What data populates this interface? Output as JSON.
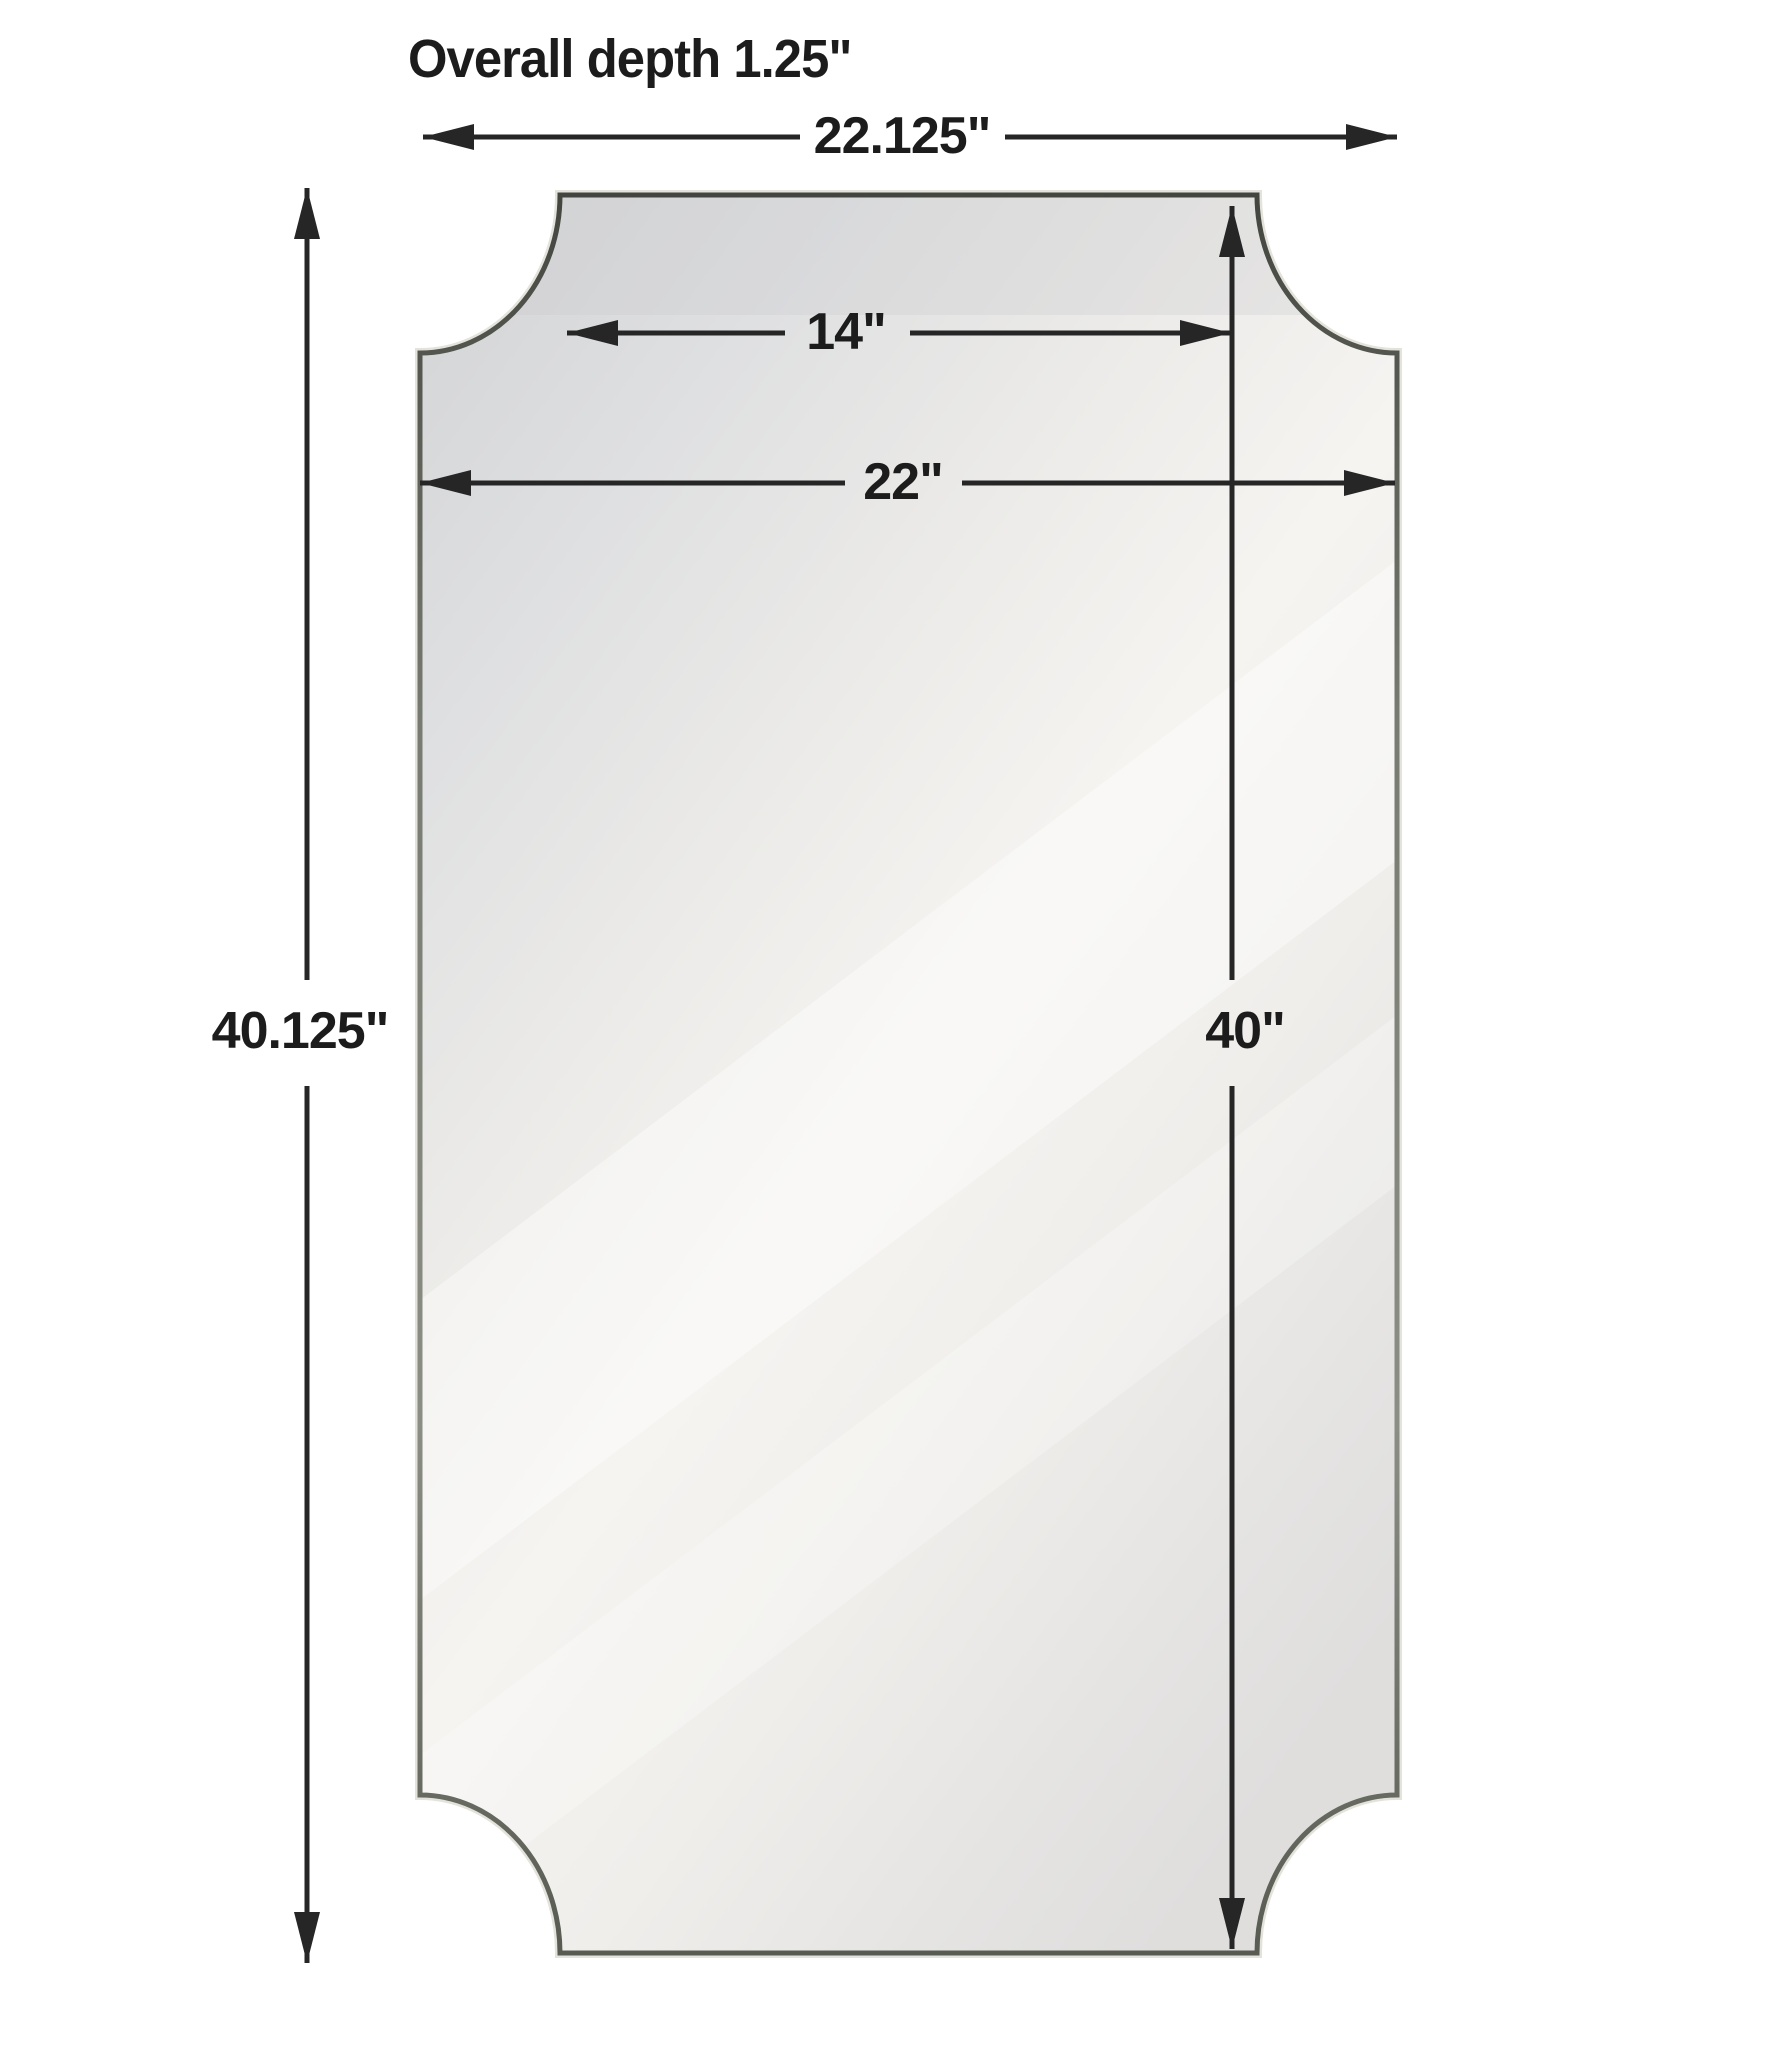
{
  "diagram": {
    "kind": "product-dimension-diagram",
    "subject": "scalloped-corner wall mirror",
    "labels": {
      "overall_depth": "Overall depth 1.25\"",
      "overall_width": "22.125\"",
      "top_width": "14\"",
      "mirror_width": "22\"",
      "overall_height": "40.125\"",
      "mirror_height": "40\""
    },
    "measurements": {
      "overall_depth_in": 1.25,
      "overall_width_in": 22.125,
      "top_edge_width_in": 14,
      "mirror_width_in": 22,
      "overall_height_in": 40.125,
      "mirror_height_in": 40
    },
    "colors": {
      "background": "#ffffff",
      "dimension_line": "#262626",
      "text": "#1c1c1c",
      "frame_dark": "#43463f",
      "frame_mid": "#787b71",
      "frame_light": "#8b8e84",
      "frame_halo": "#dcdbd2",
      "mirror_dark": "#d2d3d5",
      "mirror_light": "#f6f4f1"
    }
  }
}
